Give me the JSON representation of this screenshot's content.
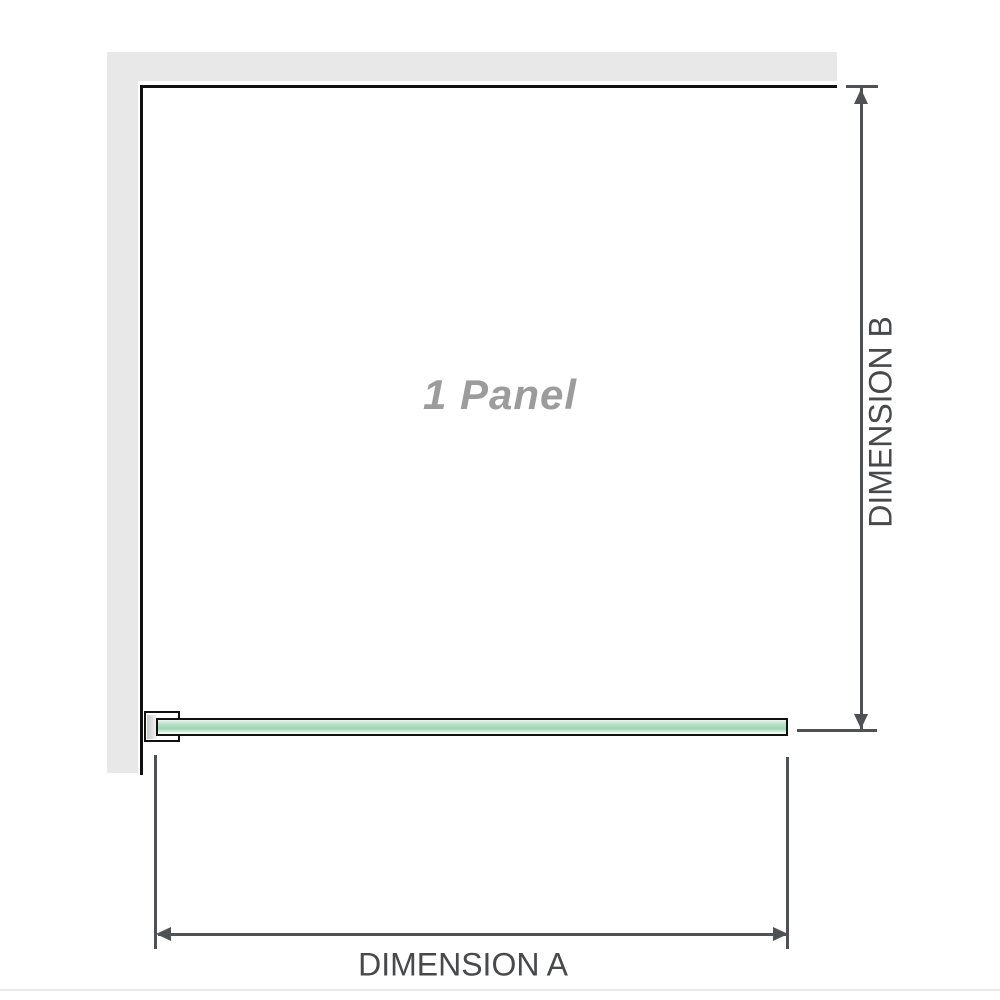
{
  "diagram": {
    "panel_label": "1 Panel",
    "dimension_a_label": "DIMENSION A",
    "dimension_b_label": "DIMENSION B"
  },
  "colors": {
    "background": "#ffffff",
    "wall": "#e8e8e8",
    "panel-outline": "#111111",
    "glass-light": "#e9f6ef",
    "glass-mid": "#b2dfc4",
    "glass-deep": "#9fd5b4",
    "clamp-gray": "#c6c6c6",
    "dimension-line": "#4e5254",
    "dimension-text": "#47494b",
    "label-gray": "#9c9c9c",
    "faint-rule": "#e9e9e6"
  }
}
